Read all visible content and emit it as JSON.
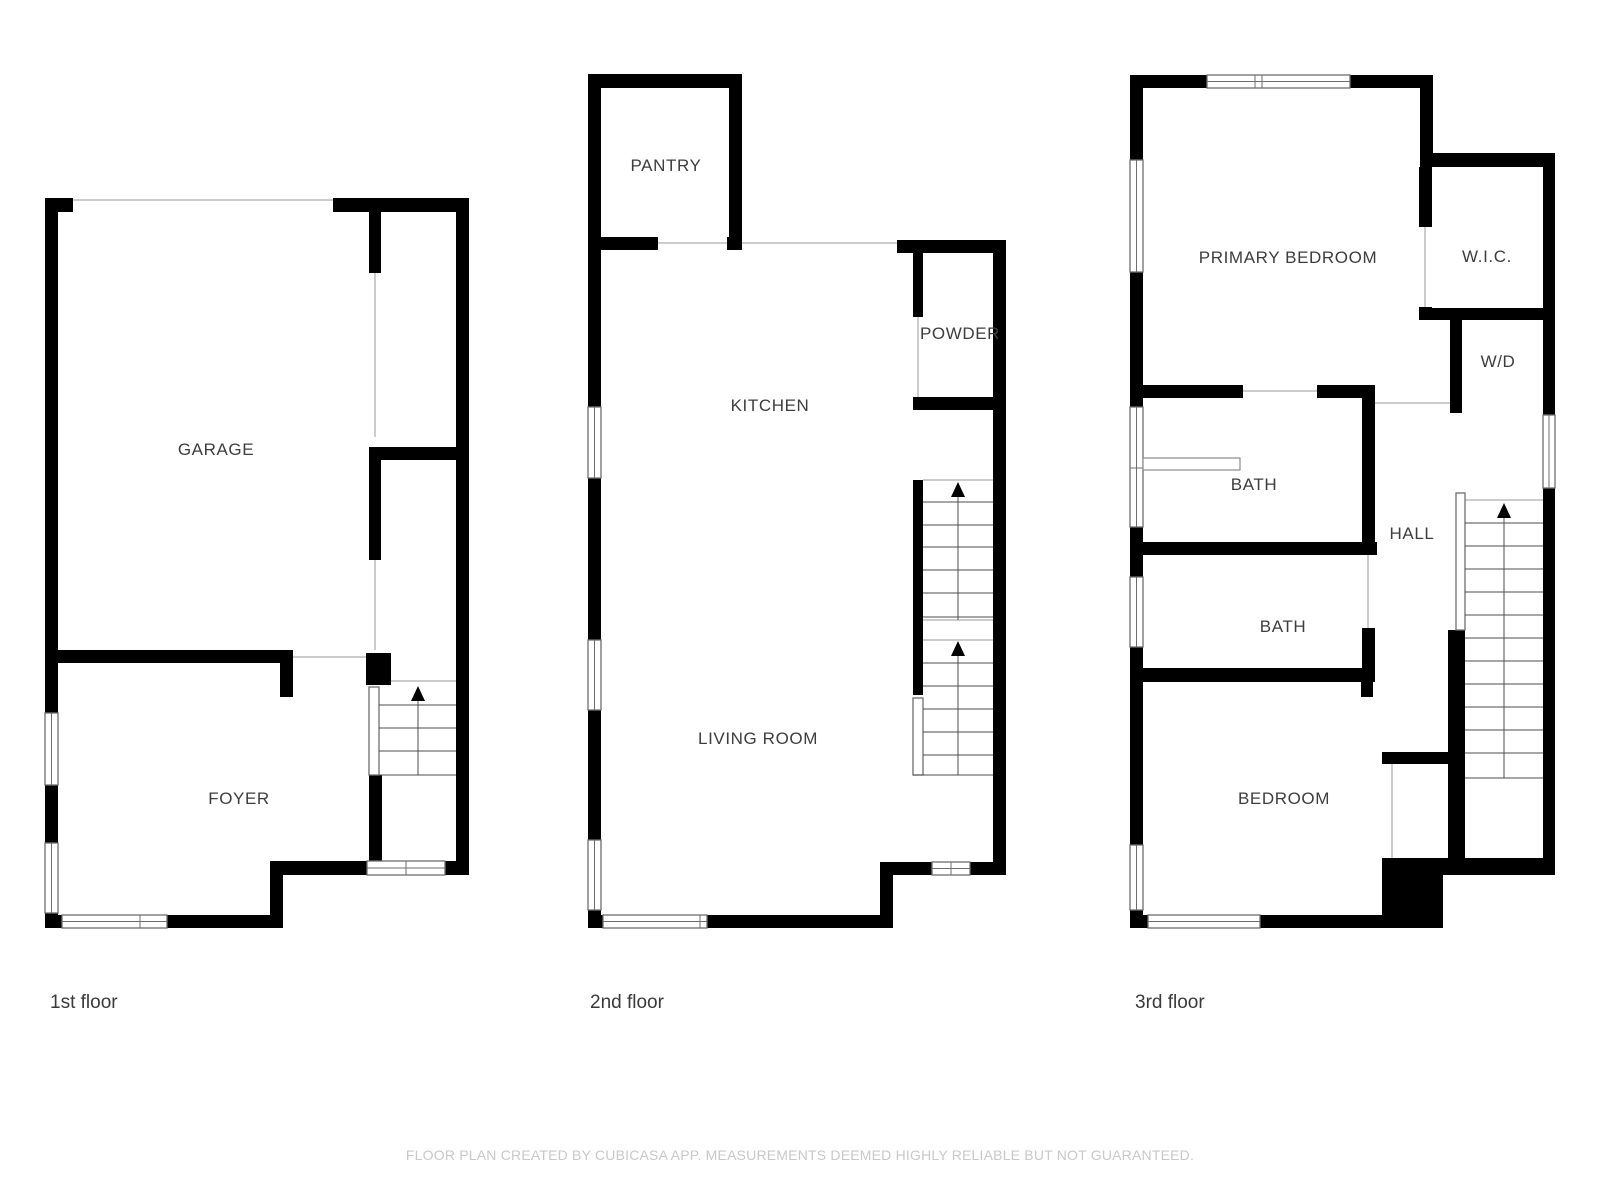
{
  "floors": [
    {
      "caption": "1st floor",
      "rooms": {
        "garage": "GARAGE",
        "foyer": "FOYER"
      }
    },
    {
      "caption": "2nd floor",
      "rooms": {
        "pantry": "PANTRY",
        "kitchen": "KITCHEN",
        "powder": "POWDER",
        "living_room": "LIVING ROOM"
      }
    },
    {
      "caption": "3rd floor",
      "rooms": {
        "primary_bedroom": "PRIMARY BEDROOM",
        "wic": "W.I.C.",
        "wd": "W/D",
        "bath_upper": "BATH",
        "hall": "HALL",
        "bath_lower": "BATH",
        "bedroom": "BEDROOM"
      }
    }
  ],
  "footer": {
    "disclaimer": "FLOOR PLAN CREATED BY CUBICASA APP. MEASUREMENTS DEEMED HIGHLY RELIABLE BUT NOT GUARANTEED."
  },
  "colors": {
    "wall": "#000000",
    "opening_line": "#bbbbbb",
    "window_border": "#6e6e6e",
    "stair_line": "#4d4d4d",
    "label_text": "#3d3d3d",
    "caption_text": "#3a3a3a",
    "disclaimer_text": "#c8c8c8",
    "background": "#ffffff"
  }
}
